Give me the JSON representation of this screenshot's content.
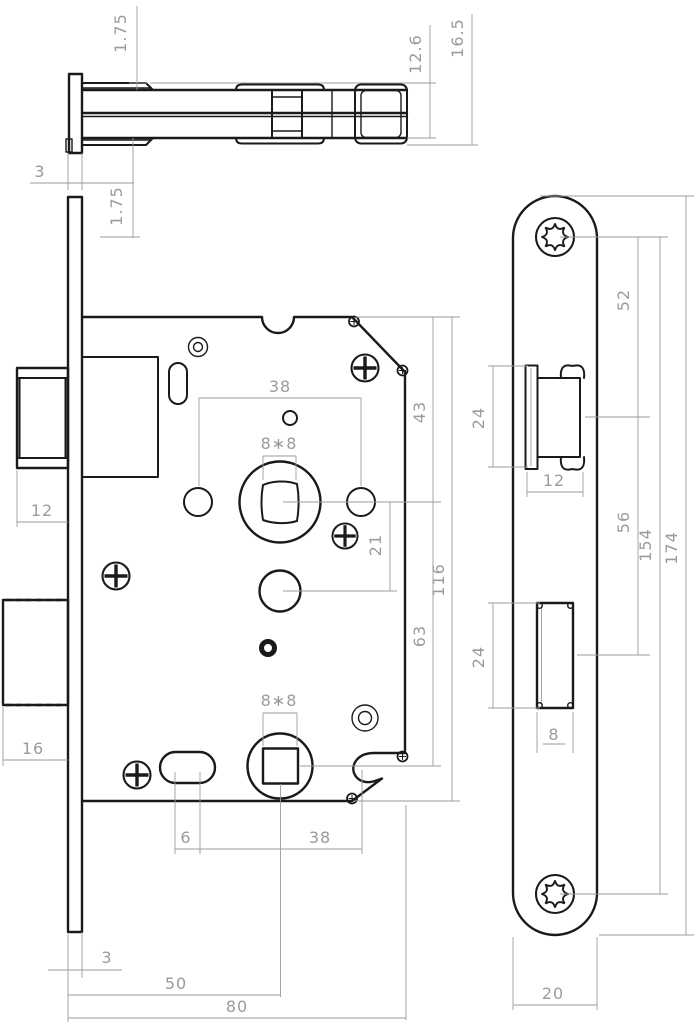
{
  "drawing_type": "mortise-lock technical drawing",
  "colors": {
    "outline": "#1a1a1a",
    "dimension": "#9b9b9b",
    "background": "#ffffff"
  },
  "dims": {
    "top_view": {
      "flange_top": "1.75",
      "inner_height": "12.6",
      "outer_height": "16.5",
      "plate_thickness": "3",
      "flange_bottom": "1.75"
    },
    "front_view": {
      "handle_circle_spacing": "38",
      "spindle_hole": "8∗8",
      "top_to_spindle": "43",
      "spindle_to_hub": "21",
      "case_height": "116",
      "spindle_to_key": "63",
      "latch_width": "12",
      "deadbolt_width": "16",
      "key_hole": "8∗8",
      "slot_width": "6",
      "key_spacing": "38",
      "plate_thickness": "3",
      "backset": "50",
      "case_depth": "80"
    },
    "side_view": {
      "screw_to_latch": "52",
      "latch_height": "24",
      "latch_width": "12",
      "latch_to_deadbolt": "56",
      "screw_spacing": "154",
      "plate_length": "174",
      "deadbolt_height": "24",
      "deadbolt_width": "8",
      "plate_width": "20"
    }
  }
}
